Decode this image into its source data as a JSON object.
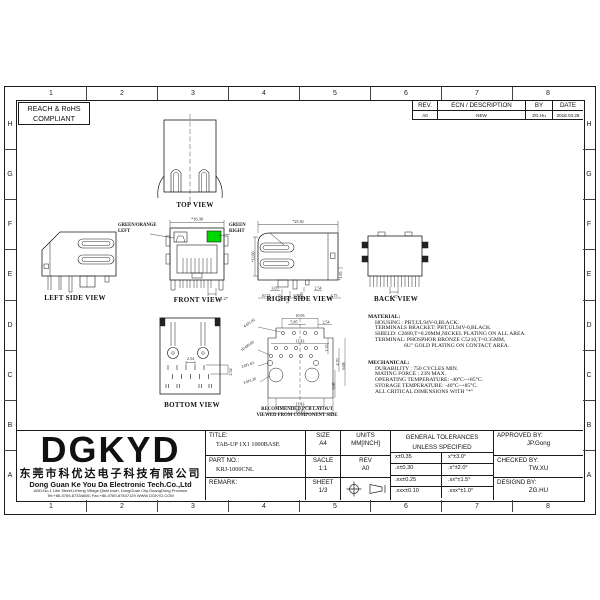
{
  "sheet": {
    "compliance": {
      "line1": "REACH & RoHS",
      "line2": "COMPLIANT"
    },
    "grid_columns": [
      "1",
      "2",
      "3",
      "4",
      "5",
      "6",
      "7",
      "8"
    ],
    "grid_rows": [
      "H",
      "G",
      "F",
      "E",
      "D",
      "C",
      "B",
      "A"
    ]
  },
  "revision_table": {
    "col_rev": "REV.",
    "col_ecn": "ECN / DESCRIPTION",
    "col_by": "BY",
    "col_date": "DATE",
    "row": {
      "rev": "A0",
      "ecn": "NEW",
      "by": "ZG.Hu",
      "date": "2018.03.28"
    }
  },
  "views": {
    "top": {
      "label": "TOP VIEW"
    },
    "left_side": {
      "label": "LEFT SIDE VIEW"
    },
    "front": {
      "label": "FRONT VIEW",
      "annotation_left_line1": "GREEN/ORANGE",
      "annotation_left_line2": "LEFT",
      "annotation_right_line1": "GREEN",
      "annotation_right_line2": "RIGHT",
      "dim_width": "*16.30",
      "dim_pin_pitch": "1.27",
      "led_color": "#00d800"
    },
    "right_side": {
      "label": "RIGHT SIDE VIEW",
      "dim_depth": "*25.30",
      "dim_height": "*13.60",
      "dim_v1": "3.20",
      "dim_v2": "3.40",
      "dim_v3": "1.30",
      "dim_v4": "*1.65",
      "dim_b1": "3.05",
      "dim_b2": "10.74",
      "dim_b3": "6.89",
      "dim_b4": "2.54",
      "dim_b5": "4.75"
    },
    "back": {
      "label": "BACK VIEW",
      "dim_pin_pitch": "1.27"
    },
    "bottom": {
      "label": "BOTTOM VIEW",
      "dim_h": "2.54",
      "dim_v": "2.54"
    },
    "pcb": {
      "label_line1": "RECOMMENDED PCB LAYOUT",
      "label_line2": "VIEWED FROM COMPONENT SIDE",
      "dim_top1": "10.93",
      "dim_top2": "5.85",
      "dim_top3": "2.54",
      "dim_mid": "11.43",
      "hole_a": "4-Ø1.02",
      "hole_b": "10-Ø0.89",
      "hole_c": "2-Ø1.63",
      "hole_d": "2-Ø3.20",
      "dim_r1": "1.35",
      "dim_r2": "4.70",
      "dim_r3": "6.68",
      "dim_r4": "5.08",
      "dim_bot1": "11.43",
      "dim_bot2": "16.10"
    }
  },
  "material": {
    "heading": "MATERIAL:",
    "lines": [
      "HOUSING : PBT,UL94V-0,BLACK.",
      "TERMINALS BRACKET: PBT,UL94V-0,BLACK.",
      "SHIELD: C2680,T=0.20MM,NICKEL PLATING ON ALL AREA.",
      "TERMINAL: PHOSPHOR BRONZE C5210,T=0.35MM,",
      "6U\" GOLD PLATING ON CONTACT AREA."
    ]
  },
  "mechanical": {
    "heading": "MECHANICAL:",
    "lines": [
      "DURABILITY : 750 CYCLES MIN.",
      "MATING FORCE : 23N MAX.",
      "OPERATING TEMPERATURE: -40°C~+85°C.",
      "STORAGE TEMPERATURE: -40°C~+85°C.",
      "ALL CRITICAL DIMENSIONS WITH \"*\""
    ]
  },
  "company": {
    "logo": "DGKYD",
    "name_cn": "东莞市科优达电子科技有限公司",
    "name_en": "Dong Guan Ke You Da Electronic Tech.Co.,Ltd",
    "address": "ADD:No.1 Litie Street,LiHeng Village,Qishi town, DongGuan City,GuangDong Province",
    "contact": "Tel:+86-0769-87334606; Fax:+86-0769-87847129  WWW.DGKYD.COM"
  },
  "title_block": {
    "title_label": "TITLE:",
    "title_value": "TAB-UP 1X1 1000BASE",
    "part_no_label": "PART NO.:",
    "part_no_value": "KRJ-1000CNL",
    "remark_label": "REMARK:",
    "size_label": "SIZE",
    "size_value": "A4",
    "scale_label": "SACLE",
    "scale_value": "1:1",
    "sheet_label": "SHEET",
    "sheet_value": "1/3",
    "units_label": "UNITS",
    "units_value": "MM[INCH]",
    "rev_label": "REV",
    "rev_value": "A0",
    "tol_header_line1": "GENERAL TOLERANCES",
    "tol_header_line2": "UNLESS SPECIFIED",
    "tol_rows": [
      {
        "lin": "x±0.35",
        "ang": "x°±3.0°"
      },
      {
        "lin": ".x±0.30",
        "ang": ".x°±2.0°"
      },
      {
        "lin": ".xx±0.25",
        "ang": ".xx°±1.5°"
      },
      {
        "lin": ".xxx±0.10",
        "ang": ".xxx°±1.0°"
      }
    ],
    "approved_label": "APPROVED BY:",
    "approved_value": "JP.Gong",
    "checked_label": "CHECKED BY:",
    "checked_value": "TW.XU",
    "designed_label": "DESIGND BY:",
    "designed_value": "ZG.HU"
  }
}
